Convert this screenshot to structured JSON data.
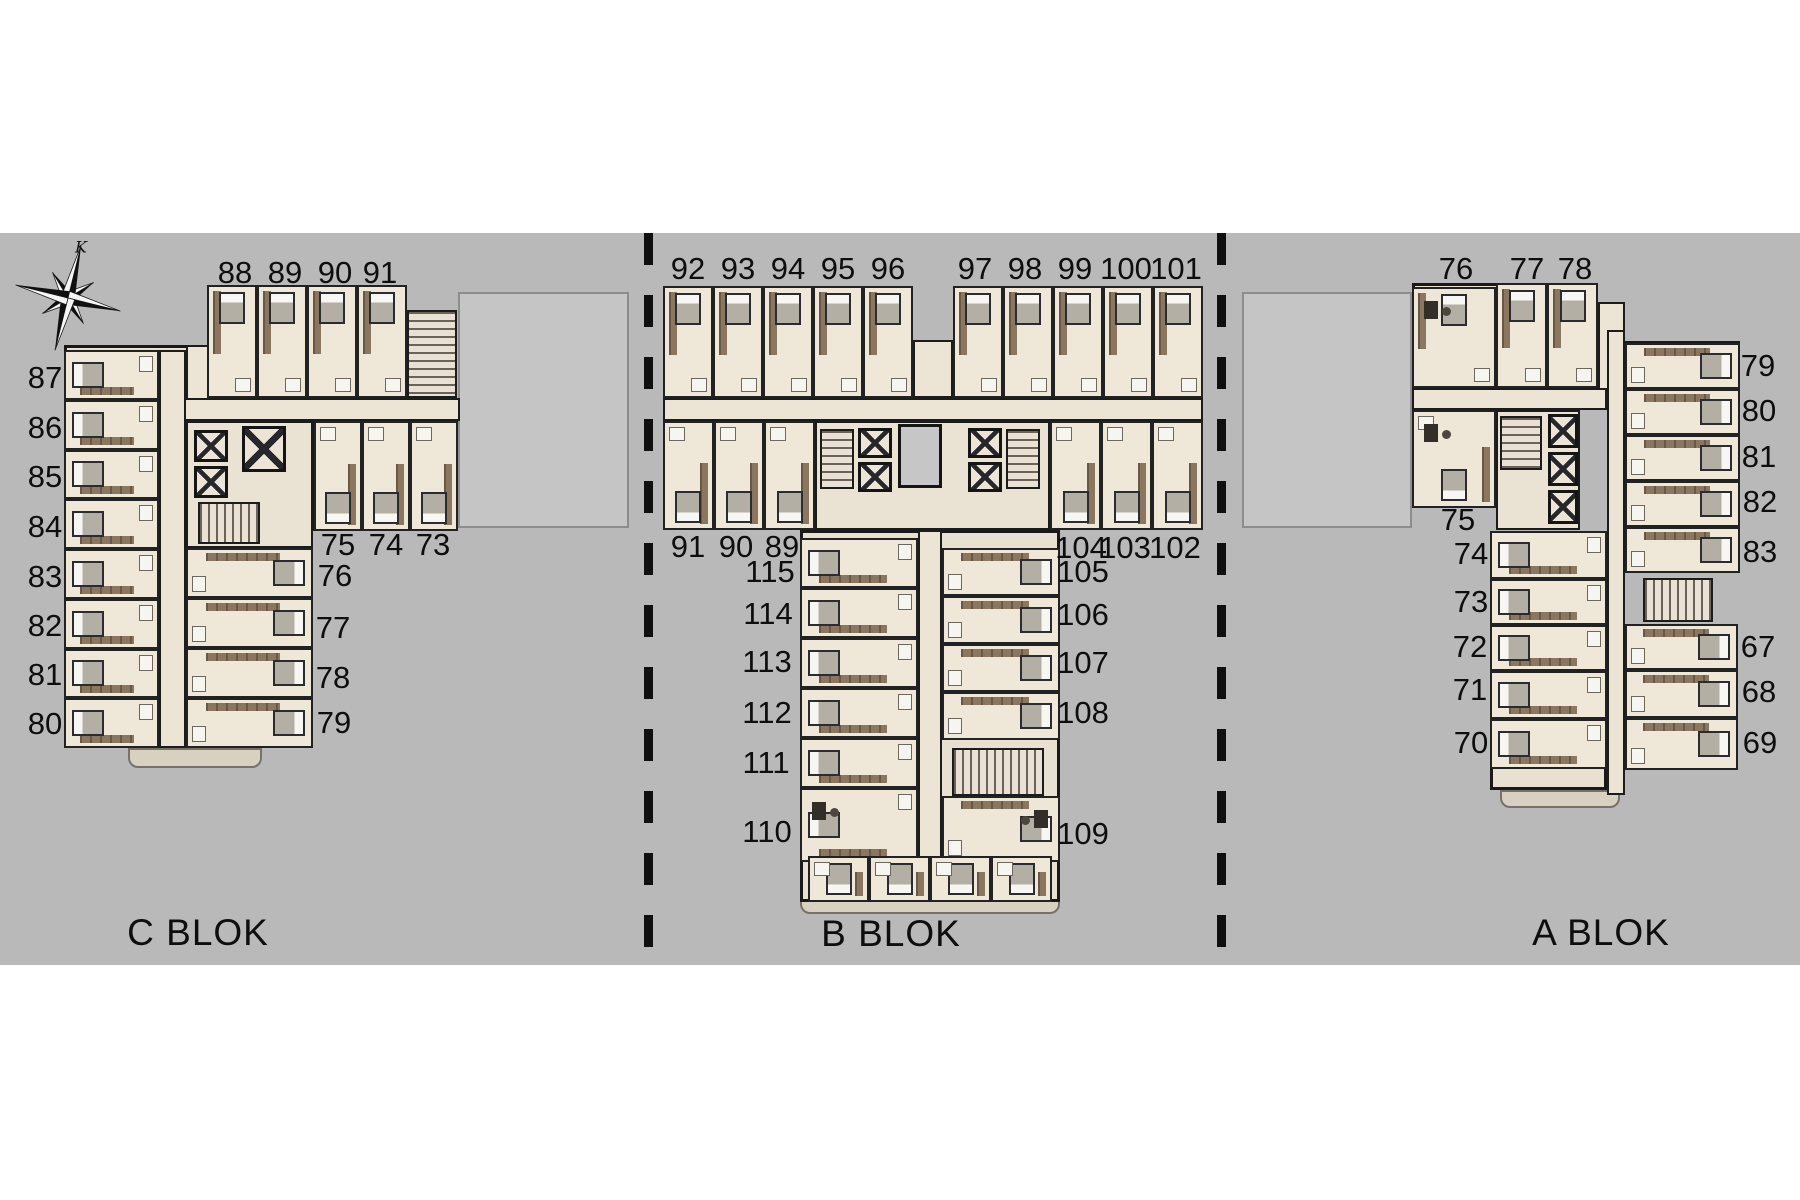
{
  "page": {
    "background": "#ffffff"
  },
  "palette": {
    "site": "#b9b9b9",
    "walls": "#1a1a1a",
    "floor": "#ece4d5",
    "wood": "#8b7660",
    "void": "#c5c5c5",
    "text": "#0e0e0e"
  },
  "compass": {
    "label": "K"
  },
  "blocks": [
    {
      "id": "c",
      "label": "C BLOK",
      "room_labels": [
        "88",
        "89",
        "90",
        "91",
        "87",
        "86",
        "85",
        "84",
        "83",
        "82",
        "81",
        "80",
        "76",
        "77",
        "78",
        "79",
        "75",
        "74",
        "73"
      ]
    },
    {
      "id": "b",
      "label": "B BLOK",
      "room_labels": [
        "92",
        "93",
        "94",
        "95",
        "96",
        "97",
        "98",
        "99",
        "100",
        "101",
        "91",
        "90",
        "89",
        "104",
        "103",
        "102",
        "115",
        "114",
        "113",
        "112",
        "111",
        "110",
        "105",
        "106",
        "107",
        "108",
        "109"
      ]
    },
    {
      "id": "a",
      "label": "A BLOK",
      "room_labels": [
        "76",
        "77",
        "78",
        "79",
        "80",
        "81",
        "82",
        "83",
        "75",
        "74",
        "73",
        "72",
        "71",
        "70",
        "67",
        "68",
        "69"
      ]
    }
  ]
}
